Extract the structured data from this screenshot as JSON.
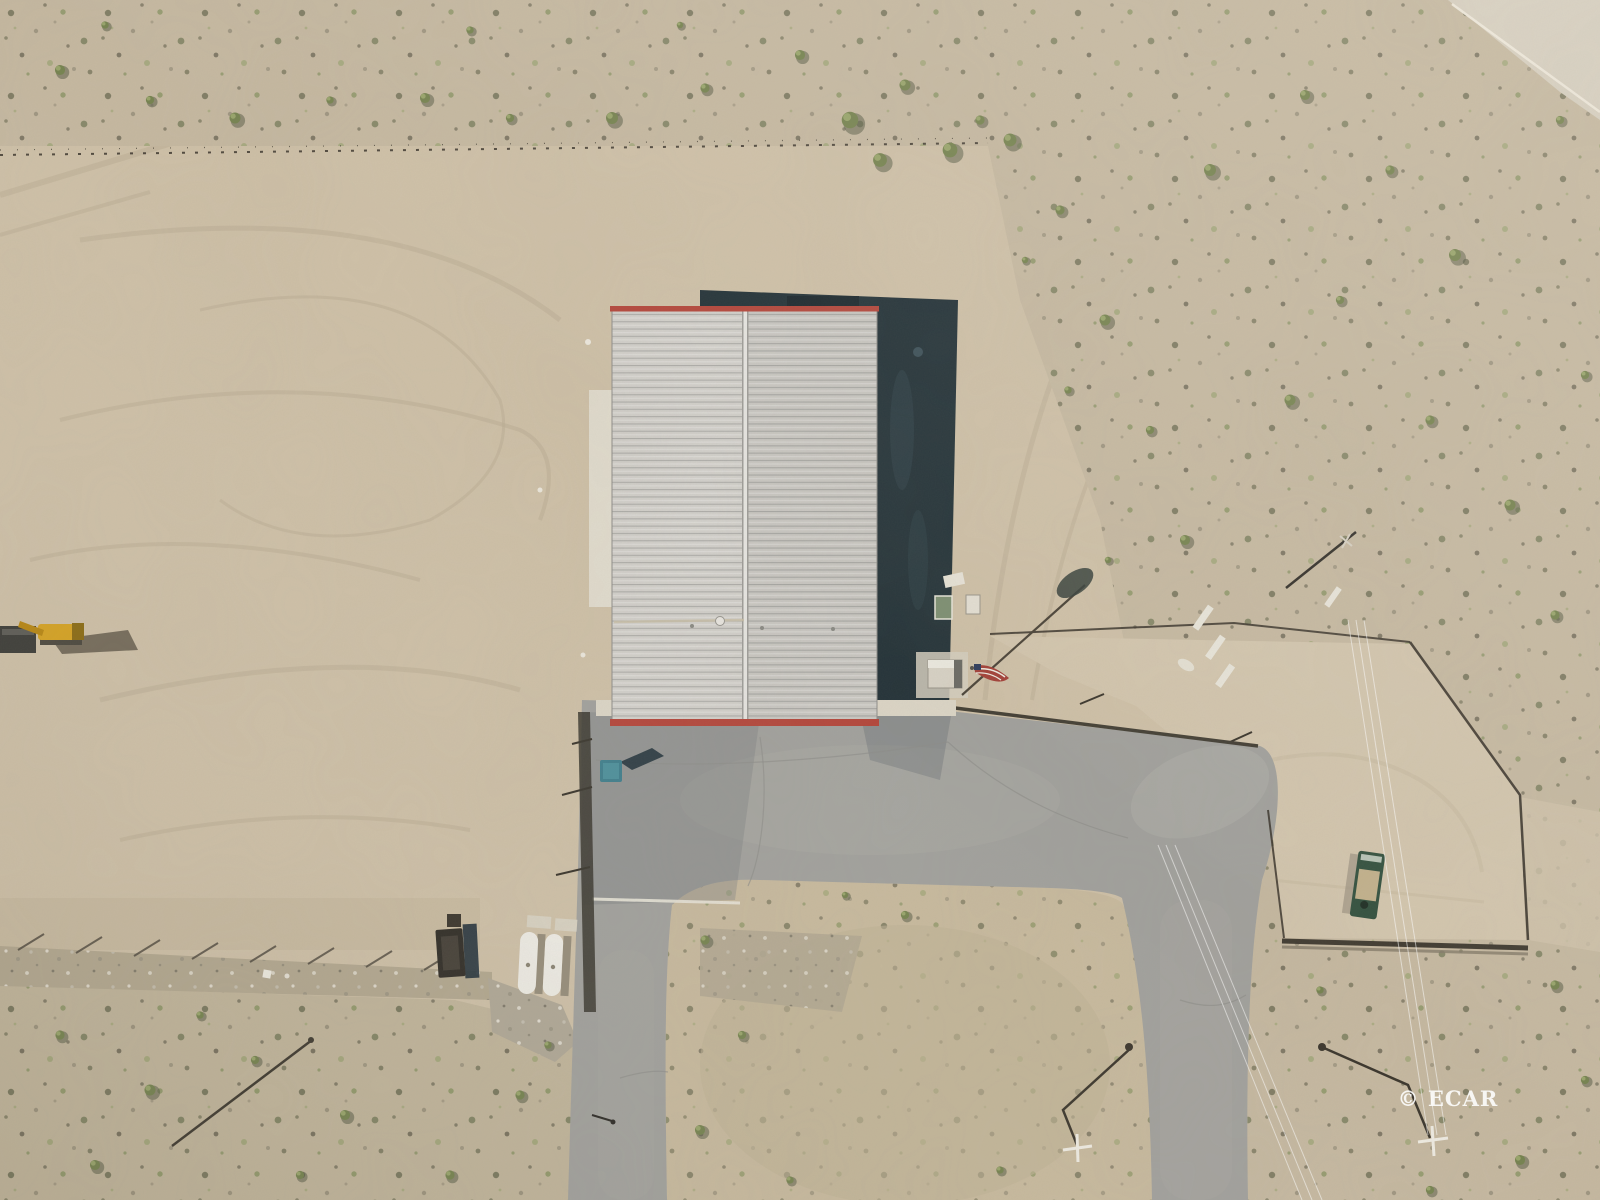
{
  "image": {
    "kind": "aerial-drone-photo",
    "width": 1600,
    "height": 1200
  },
  "watermark": {
    "text": "© ECAR",
    "color": "#ffffff"
  },
  "objects": [
    "warehouse-roof",
    "building-shadow",
    "concrete-apron",
    "paved-apron",
    "access-road-left",
    "access-road-right",
    "dirt-island",
    "fenced-enclosure",
    "scrubland",
    "graded-lot",
    "gravel-strip",
    "flag",
    "flatbed-truck",
    "excavator",
    "blue-dumpster",
    "dark-container",
    "white-tanks",
    "utility-poles",
    "power-lines",
    "concrete-barriers",
    "shed"
  ],
  "palette": {
    "lot": "#cfc1a8",
    "scrub": "#c6b9a1",
    "scrubLow": "#c1b59b",
    "island": "#c8ba9e",
    "enclosure": "#d3c6ae",
    "gravel": "#b3a890",
    "rock": "#b0a897",
    "pave": "#a1a19d",
    "paveLight": "#aeada8",
    "concrete": "#dcd6c7",
    "apron": "#e2ddcf",
    "roofL": "#d2d0cb",
    "roofR": "#c9c7c2",
    "ridge": "#e7e6e2",
    "trim": "#b4463b",
    "shadow": "#233238",
    "shadowDeep": "#1a272d",
    "fence": "#38332a",
    "dumpster": "#3f7f8d",
    "container": "#2f2c26",
    "tank": "#efede6",
    "truck": "#32503e",
    "truckBed": "#c2b18c",
    "digger": "#d7a31f",
    "flagRed": "#a34038",
    "flagBlue": "#2f3c5c",
    "white": "#f1eee6",
    "roadTR": "#d7d0c1"
  }
}
